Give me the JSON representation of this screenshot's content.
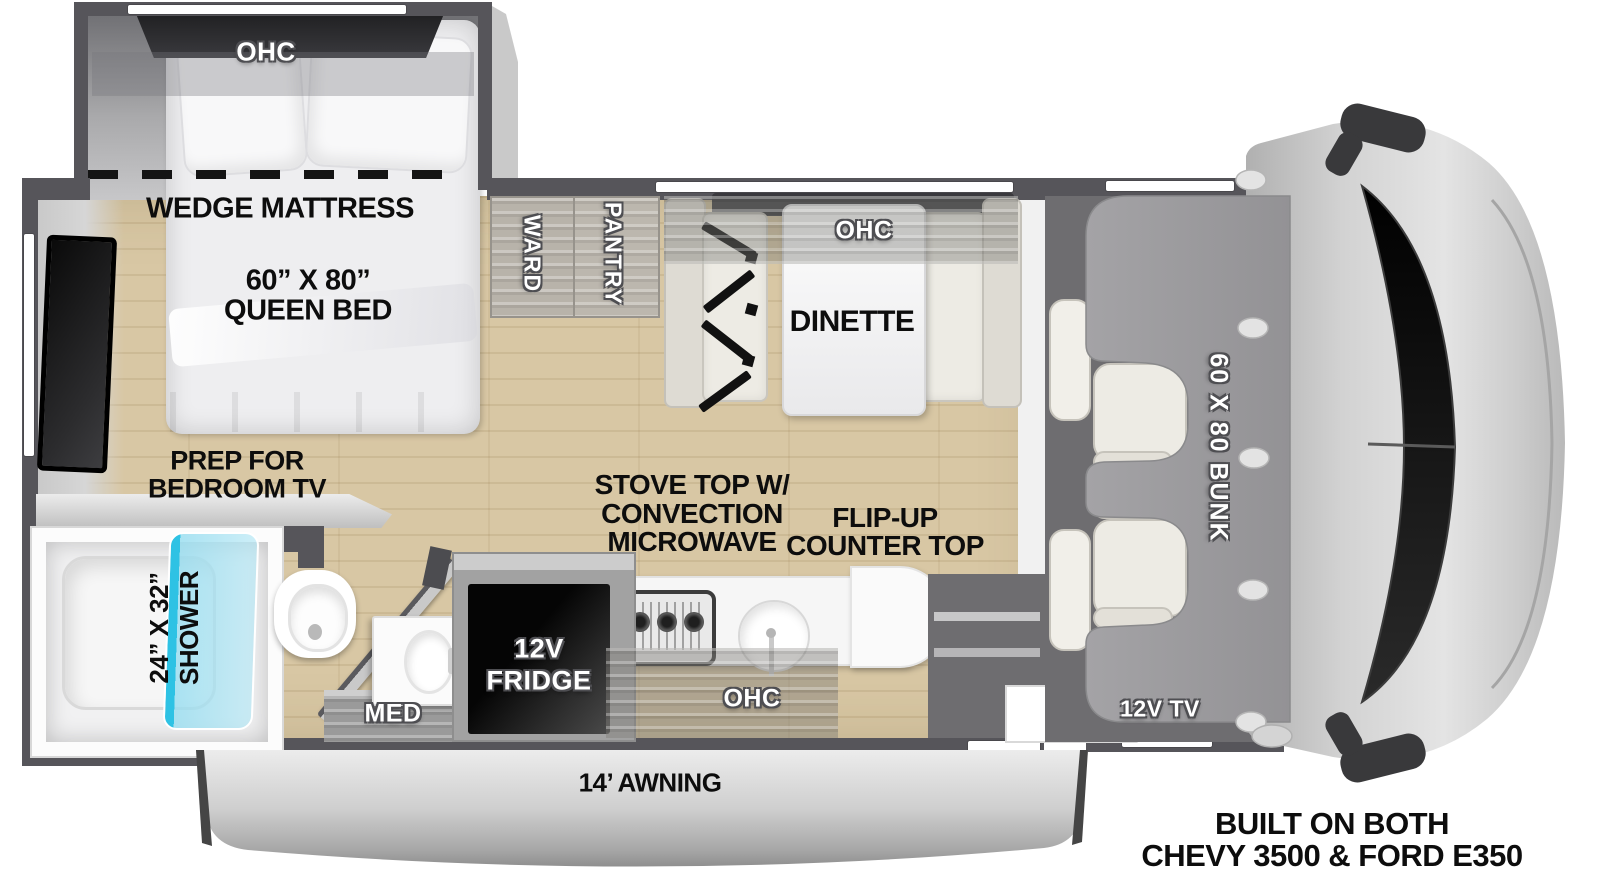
{
  "floorplan": {
    "bedroom": {
      "ohc_label": "OHC",
      "mattress_label": "WEDGE MATTRESS",
      "bed_size": "60” X 80”",
      "bed_type": "QUEEN BED",
      "tv_prep_line1": "PREP FOR",
      "tv_prep_line2": "BEDROOM TV"
    },
    "storage": {
      "wardrobe_label": "WARD",
      "pantry_label": "PANTRY"
    },
    "dinette": {
      "ohc_label": "OHC",
      "label": "DINETTE"
    },
    "bathroom": {
      "shower_size": "24” X 32”",
      "shower_label": "SHOWER",
      "med_label": "MED"
    },
    "kitchen": {
      "stove_line1": "STOVE TOP W/",
      "stove_line2": "CONVECTION",
      "stove_line3": "MICROWAVE",
      "flipup_line1": "FLIP-UP",
      "flipup_line2": "COUNTER TOP",
      "fridge_line1": "12V",
      "fridge_line2": "FRIDGE",
      "ohc_label": "OHC"
    },
    "cab": {
      "bunk_label": "60 X 80 BUNK",
      "tv_label": "12V TV"
    },
    "exterior": {
      "awning_label": "14’ AWNING"
    },
    "footer": {
      "line1": "BUILT ON BOTH",
      "line2": "CHEVY 3500 & FORD E350"
    },
    "colors": {
      "wall": "#56555a",
      "floor": "#d8c7a4",
      "shower_glass": "#35c4e4",
      "bunk": "#9c9b9d",
      "cab_floor": "#6e6d70",
      "awning": "#c9c9c9"
    }
  }
}
